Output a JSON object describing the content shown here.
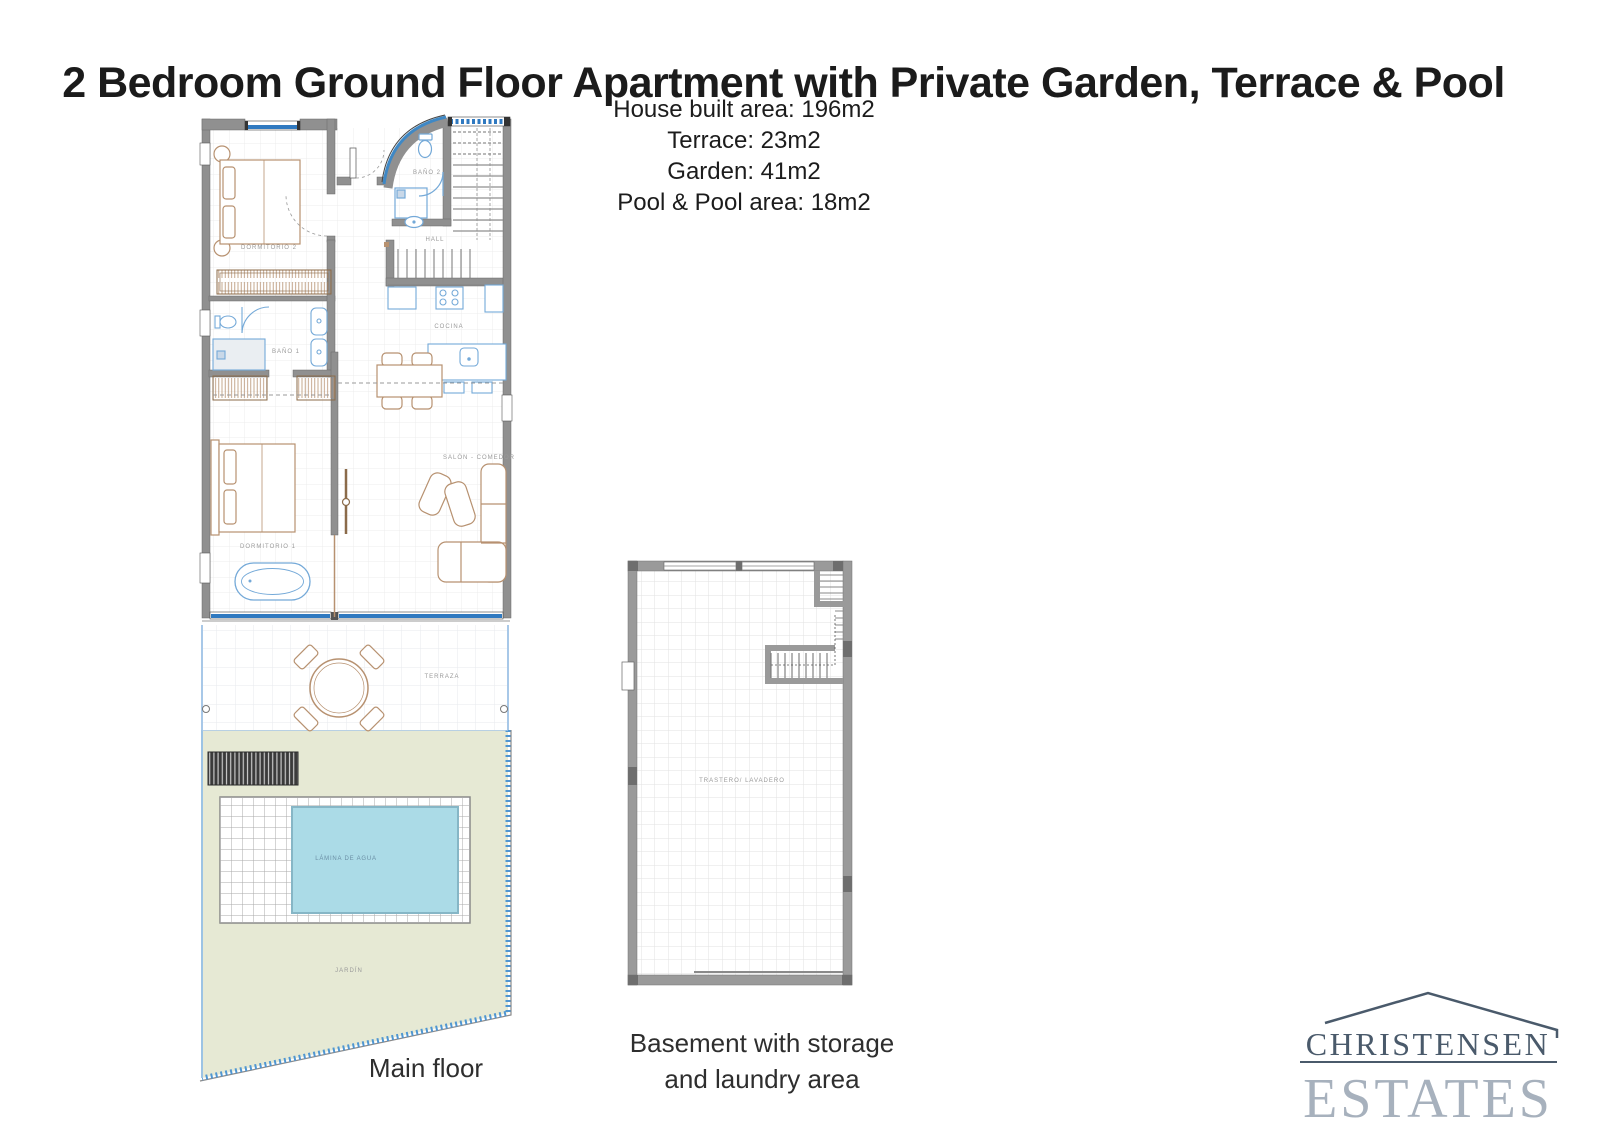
{
  "title": "2 Bedroom Ground Floor Apartment with Private Garden, Terrace & Pool",
  "area_info": {
    "line1": "House built area: 196m2",
    "line2": "Terrace: 23m2",
    "line3": "Garden: 41m2",
    "line4": "Pool & Pool area: 18m2"
  },
  "main_floor": {
    "caption": "Main floor",
    "labels": {
      "dormitorio2": "DORMITORIO 2",
      "hall": "HALL",
      "bano2": "BAÑO 2",
      "cocina": "COCINA",
      "bano1": "BAÑO 1",
      "salon_comedor": "SALÓN - COMEDOR",
      "dormitorio1": "DORMITORIO 1",
      "terraza": "TERRAZA",
      "lamina_de_agua": "LÁMINA DE AGUA",
      "jardin": "JARDÍN"
    }
  },
  "basement": {
    "caption_line1": "Basement with storage",
    "caption_line2": "and laundry area",
    "labels": {
      "trastero": "TRASTERO/ LAVADERO"
    }
  },
  "logo": {
    "line1": "CHRISTENSEN",
    "line2": "ESTATES"
  },
  "colors": {
    "wall_gray": "#909090",
    "window_blue": "#2f79c0",
    "glazing_blue": "#3f88c5",
    "fixture_blue": "#74a9d8",
    "furniture_tan": "#b79170",
    "pool_fill": "#abdbe7",
    "garden_fill": "#e6e9d4",
    "logo_dark": "#4a5a6b",
    "logo_light": "#a7b1bd",
    "label_gray": "#9a9a9a"
  }
}
